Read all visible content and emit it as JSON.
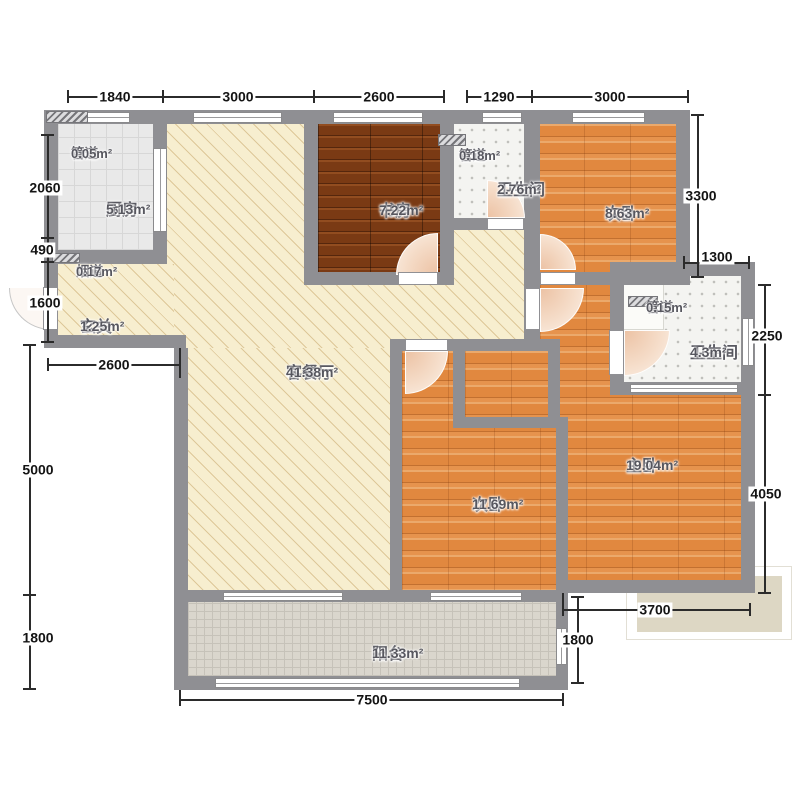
{
  "rooms": {
    "duct_tl": {
      "name": "管道",
      "area": "0.05m²"
    },
    "kitchen": {
      "name": "厨房",
      "area": "5.13m²"
    },
    "flue": {
      "name": "烟道",
      "area": "0.17m²"
    },
    "entry": {
      "name": "玄关",
      "area": "1.25m²"
    },
    "living": {
      "name": "客餐厅",
      "area": "41.38m²"
    },
    "study": {
      "name": "书房",
      "area": "7.22m²"
    },
    "duct_top": {
      "name": "管道",
      "area": "0.18m²"
    },
    "bath_top": {
      "name": "卫生间",
      "area": "2.76m²"
    },
    "bed_top": {
      "name": "次卧",
      "area": "8.63m²"
    },
    "duct_right": {
      "name": "管道",
      "area": "0.15m²"
    },
    "bath_right": {
      "name": "卫生间",
      "area": "4.3m²"
    },
    "master": {
      "name": "主卧",
      "area": "19.04m²"
    },
    "bed_mid": {
      "name": "次卧",
      "area": "11.69m²"
    },
    "balcony": {
      "name": "阳台",
      "area": "11.33m²"
    }
  },
  "dimensions": {
    "top": [
      "1840",
      "3000",
      "2600",
      "1290",
      "3000"
    ],
    "left": [
      "2060",
      "490",
      "1600",
      "2600"
    ],
    "left_lower": [
      "5000",
      "1800"
    ],
    "right": [
      "3300",
      "1300",
      "2250",
      "4050"
    ],
    "bottom": [
      "3700",
      "1800",
      "7500"
    ]
  },
  "colors": {
    "wall": "#8f8f93",
    "wood": "#e1883f",
    "wood_dark": "#7a3a14",
    "cream": "#f7eecf",
    "kitchen_tile": "#e9e9e9",
    "bath_tile": "#f4f4f1",
    "balcony_tile": "#dad6cd",
    "platform": "#ddd7c4",
    "dim_text": "#141414",
    "label_text": "#57575f"
  }
}
